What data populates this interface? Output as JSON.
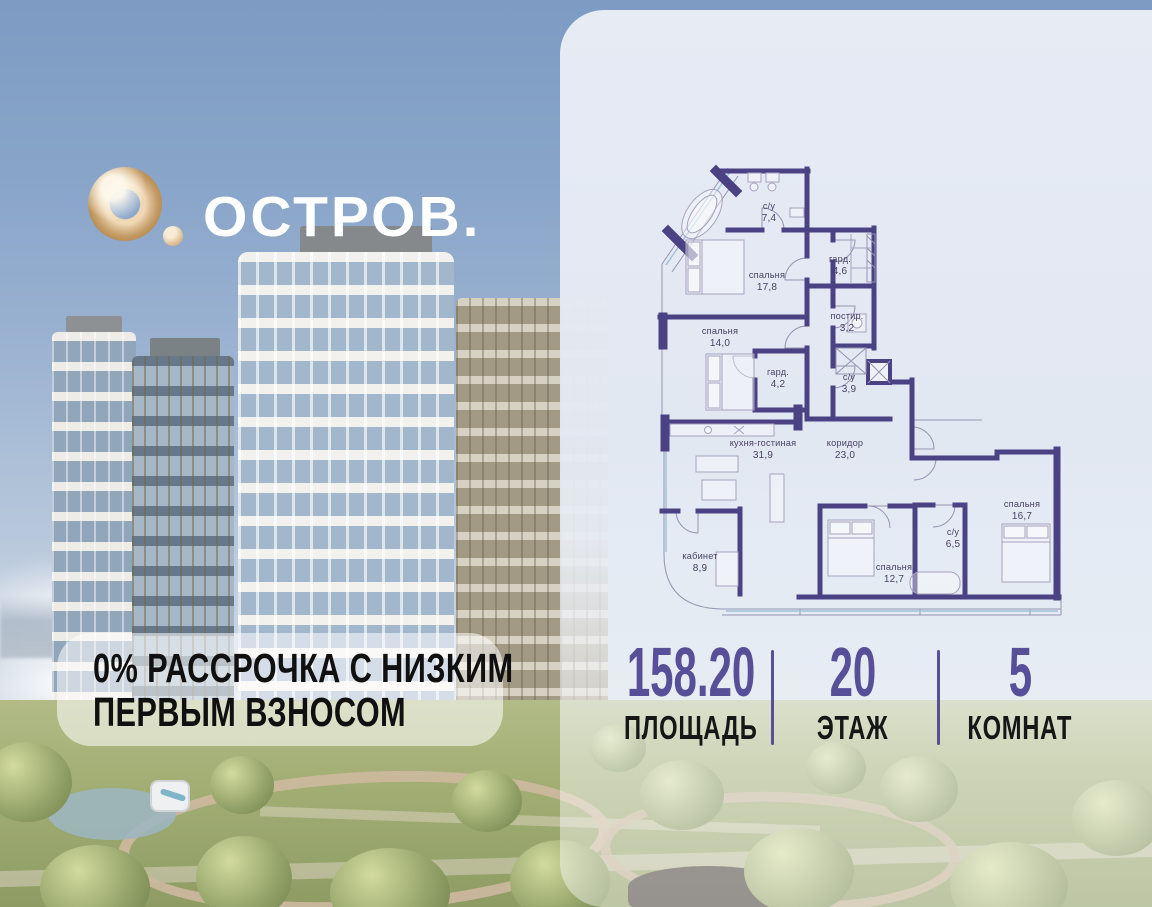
{
  "logo": {
    "brand": "ОСТРОВ."
  },
  "promo": {
    "line1": "0% РАССРОЧКА С НИЗКИМ",
    "line2": "ПЕРВЫМ ВЗНОСОМ"
  },
  "stats": {
    "items": [
      {
        "value": "158.20",
        "label": "ПЛОЩАДЬ"
      },
      {
        "value": "20",
        "label": "ЭТАЖ"
      },
      {
        "value": "5",
        "label": "КОМНАТ"
      }
    ]
  },
  "plan": {
    "rooms": [
      {
        "name": "с/у",
        "area": "7,4"
      },
      {
        "name": "спальня",
        "area": "17,8"
      },
      {
        "name": "гард.",
        "area": "4,6"
      },
      {
        "name": "постир.",
        "area": "3,2"
      },
      {
        "name": "спальня",
        "area": "14,0"
      },
      {
        "name": "гард.",
        "area": "4,2"
      },
      {
        "name": "с/у",
        "area": "3,9"
      },
      {
        "name": "кухня-гостиная",
        "area": "31,9"
      },
      {
        "name": "коридор",
        "area": "23,0"
      },
      {
        "name": "кабинет",
        "area": "8,9"
      },
      {
        "name": "спальня",
        "area": "12,7"
      },
      {
        "name": "с/у",
        "area": "6,5"
      },
      {
        "name": "спальня",
        "area": "16,7"
      }
    ]
  },
  "colors": {
    "accent_purple": "#574f98",
    "plan_wall": "#4b4284",
    "logo_gold": "#d9b98f",
    "panel_bg": "#e8ecf4",
    "sky": "#7d9bc3"
  }
}
